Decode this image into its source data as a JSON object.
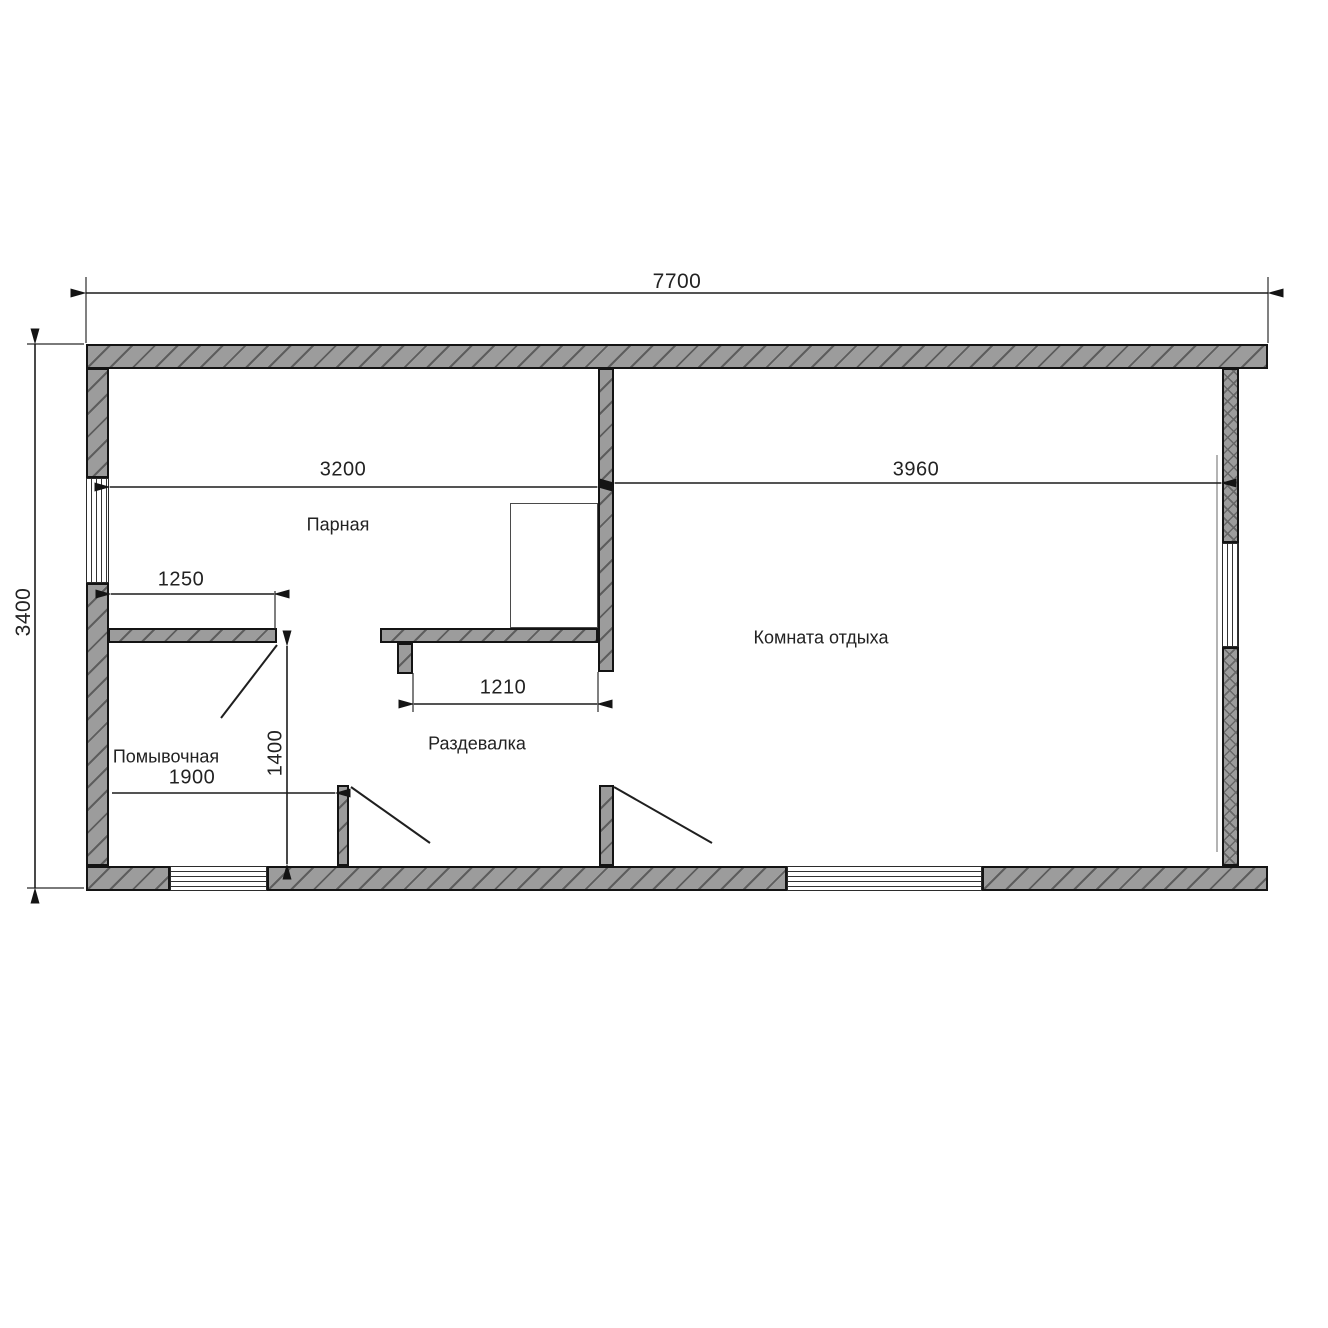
{
  "drawing": {
    "type": "floor-plan",
    "rooms": [
      {
        "name": "Парная"
      },
      {
        "name": "Комната отдыха"
      },
      {
        "name": "Помывочная"
      },
      {
        "name": "Раздевалка"
      }
    ],
    "dimensions": {
      "overall_width": "7700",
      "overall_height": "3400",
      "steam_room_width": "3200",
      "rest_room_width": "3960",
      "washroom_wall": "1250",
      "dressing_opening": "1210",
      "dressing_depth": "1400",
      "washroom_width": "1900"
    },
    "colors": {
      "wall_fill": "#9c9c9c",
      "hatch_line": "#5d5d5d",
      "outline": "#141414",
      "dimension_line": "#1c1c1c",
      "text": "#222222",
      "background": "#ffffff"
    }
  }
}
